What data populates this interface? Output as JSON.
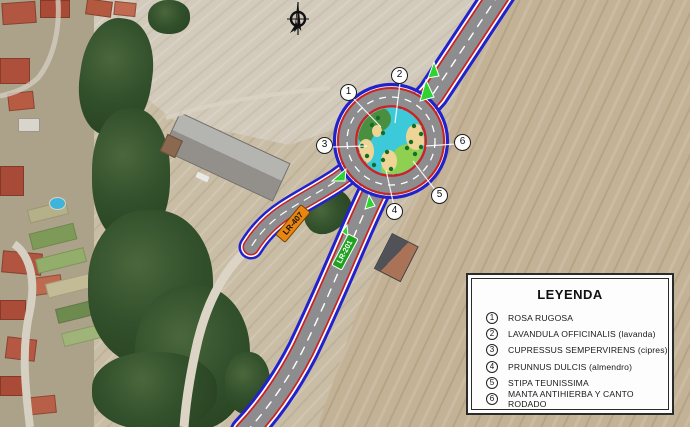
{
  "legend": {
    "title": "LEYENDA",
    "items": [
      {
        "num": "1",
        "label": "ROSA RUGOSA"
      },
      {
        "num": "2",
        "label": "LAVANDULA OFFICINALIS (lavanda)"
      },
      {
        "num": "3",
        "label": "CUPRESSUS SEMPERVIRENS (cipres)"
      },
      {
        "num": "4",
        "label": "PRUNNUS DULCIS (almendro)"
      },
      {
        "num": "5",
        "label": "STIPA TEUNISSIMA"
      },
      {
        "num": "6",
        "label": "MANTA ANTIHIERBA Y CANTO RODADO"
      }
    ]
  },
  "callouts": [
    {
      "num": "1"
    },
    {
      "num": "2"
    },
    {
      "num": "3"
    },
    {
      "num": "4"
    },
    {
      "num": "5"
    },
    {
      "num": "6"
    }
  ],
  "road_labels": [
    {
      "text": "LR-407",
      "bg": "#e8860f",
      "text_color": "#111111"
    },
    {
      "text": "LR-201",
      "bg": "#1fa21f",
      "text_color": "#ffffff"
    }
  ],
  "icons": {
    "north_arrow": "north-arrow-compass"
  },
  "colors": {
    "design_edge_blue": "#2222cc",
    "design_edge_red": "#cc2222",
    "asphalt_gray": "#8d8d8f",
    "island_cyan": "#3cc9da",
    "island_dark_green": "#4a8f3f",
    "island_light_green": "#90d050",
    "island_gravel_tan": "#eed596",
    "splitter_island_green": "#2fd32f"
  }
}
